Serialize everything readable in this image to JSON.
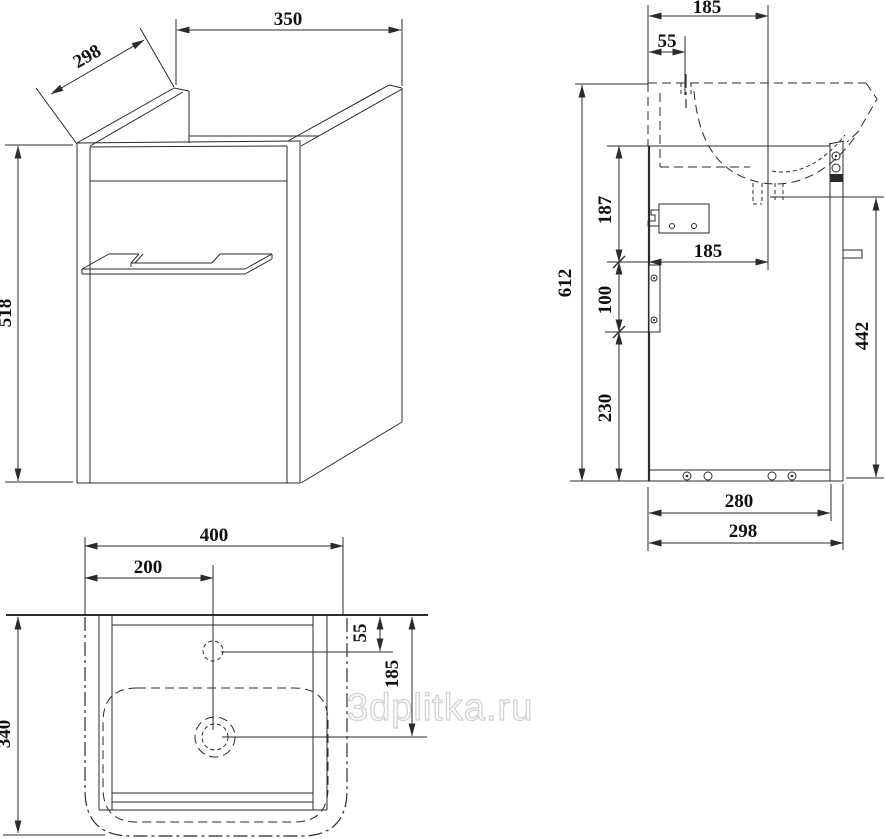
{
  "watermark": {
    "text": "3dplitka.ru"
  },
  "front_view": {
    "dim_width": "350",
    "dim_depth": "298",
    "dim_height": "518"
  },
  "side_view": {
    "dim_width_top": "185",
    "dim_faucet": "55",
    "dim_upper": "187",
    "dim_mid": "185",
    "dim_height": "612",
    "dim_bracket": "100",
    "dim_lower": "230",
    "dim_back": "442",
    "dim_bottom_inner": "280",
    "dim_bottom": "298"
  },
  "plan_view": {
    "dim_width": "400",
    "dim_center": "200",
    "dim_depth": "340",
    "dim_faucet": "55",
    "dim_drain": "185"
  }
}
